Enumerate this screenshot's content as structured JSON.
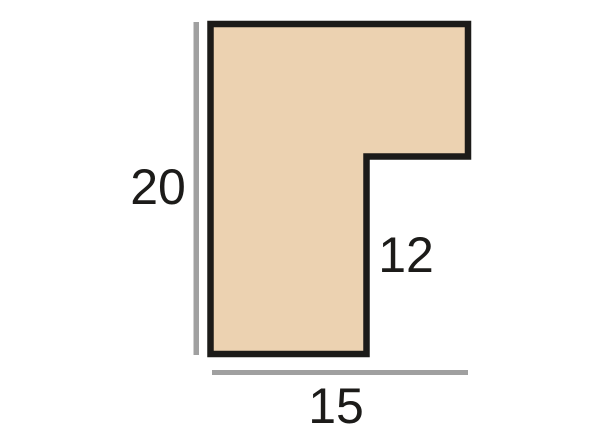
{
  "diagram": {
    "type": "picture-frame-moulding-profile-cross-section",
    "dimensions": {
      "height": "20",
      "width": "15",
      "rebate_depth": "12"
    },
    "shape": {
      "name": "moulding-profile",
      "points": "210.5,24 468,24 468,156.5 366.5,156.5 366.5,354 210.5,354"
    },
    "dimension_lines": {
      "height_line": {
        "x": 193.5,
        "y": 22,
        "width": 5.5,
        "height": 333
      },
      "width_line": {
        "x": 212,
        "y": 370,
        "width": 256,
        "height": 5
      }
    },
    "colors": {
      "profile_fill": "#ecd2b1",
      "profile_stroke": "#1c1b19",
      "dimension_line": "#a0a0a0",
      "label_text": "#1c1b19",
      "background": "#ffffff"
    }
  }
}
